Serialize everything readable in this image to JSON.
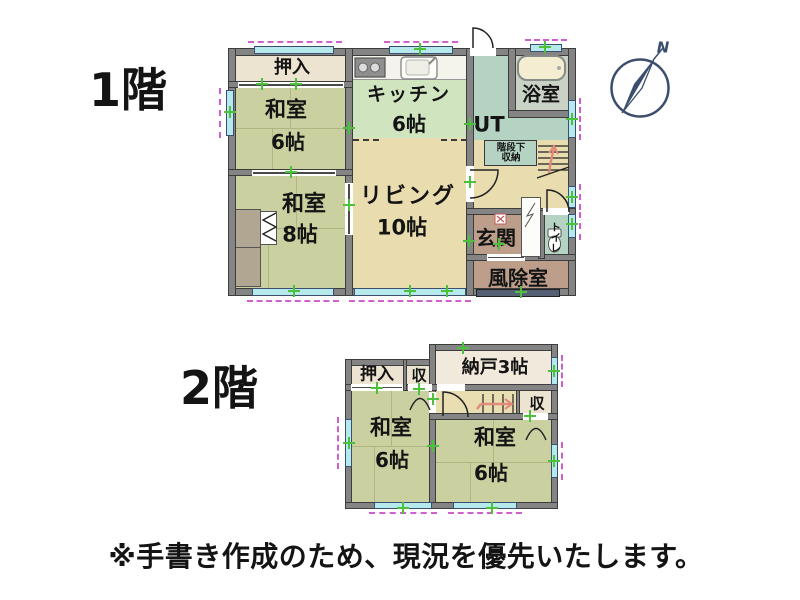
{
  "floor1": {
    "label": "1階",
    "rooms": {
      "oshiire": {
        "label": "押入"
      },
      "washitsu6": {
        "label": "和室",
        "size": "6帖"
      },
      "washitsu8": {
        "label": "和室",
        "size": "8帖"
      },
      "kitchen": {
        "label": "キッチン",
        "size": "6帖"
      },
      "living": {
        "label": "リビング",
        "size": "10帖"
      },
      "ut": {
        "label": "UT"
      },
      "bath": {
        "label": "浴室"
      },
      "stair_storage": {
        "line1": "階段下",
        "line2": "収納"
      },
      "genkan": {
        "label": "玄関"
      },
      "toilet": {
        "label": "トイレ"
      },
      "windbreak": {
        "label": "風除室"
      }
    }
  },
  "floor2": {
    "label": "2階",
    "rooms": {
      "oshiire": {
        "label": "押入"
      },
      "closet_left": {
        "label": "収"
      },
      "nando": {
        "label": "納戸3帖"
      },
      "closet_right": {
        "label": "収"
      },
      "washitsu_left": {
        "label": "和室",
        "size": "6帖"
      },
      "washitsu_right": {
        "label": "和室",
        "size": "6帖"
      }
    }
  },
  "compass": {
    "label": "N"
  },
  "footnote": "※手書き作成のため、現況を優先いたします。",
  "palette": {
    "wall": "#848484",
    "tatami": "#cbd0a0",
    "closet_cream": "#ece4d1",
    "nando_cream": "#f1e9db",
    "kitchen_green": "#cfe4bf",
    "living_tan": "#e9dcae",
    "water_teal": "#b5d3c3",
    "bath_floor": "#c9d2c5",
    "bathtub": "#f4edd2",
    "entrance_brown": "#bd9e8b",
    "alcove_brown": "#b1a692",
    "window_cyan": "#b6e9eb",
    "window_dash_magenta": "#d05fd0",
    "marker_green": "#4ec13c",
    "stair_arrow_red": "#e08a78",
    "compass_navy": "#3c4e6e"
  },
  "icons": {
    "compass": "compass-rose-north",
    "bathtub": "bathtub-top-view",
    "toilet": "toilet-top-view",
    "stove": "gas-stove-top-view",
    "sink": "kitchen-sink-top-view",
    "stairs": "stairs-with-direction-arrow",
    "door": "door-swing-arc",
    "closet_door": "double-swing-arch",
    "folding_door": "folding-door-zigzag",
    "window": "window-bar-with-dashed-outline"
  }
}
